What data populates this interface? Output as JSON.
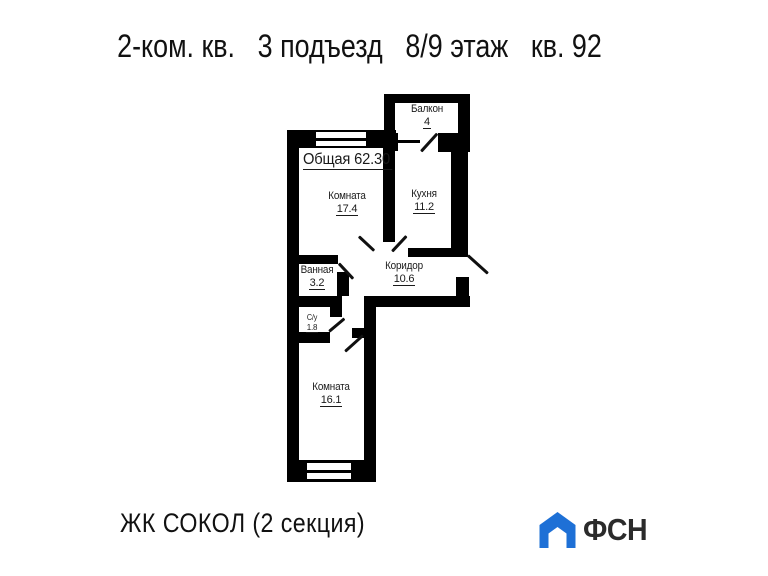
{
  "header": {
    "segments": [
      "2-ком. кв.",
      "3 подъезд",
      "8/9 этаж",
      "кв. 92"
    ]
  },
  "plan": {
    "total_label": "Общая 62.30",
    "rooms": [
      {
        "id": "balcony",
        "name": "Балкон",
        "area": "4"
      },
      {
        "id": "room-1",
        "name": "Комната",
        "area": "17.4"
      },
      {
        "id": "kitchen",
        "name": "Кухня",
        "area": "11.2"
      },
      {
        "id": "bathroom",
        "name": "Ванная",
        "area": "3.2"
      },
      {
        "id": "corridor",
        "name": "Коридор",
        "area": "10.6"
      },
      {
        "id": "wc",
        "name": "С/у",
        "area": "1.8"
      },
      {
        "id": "room-2",
        "name": "Комната",
        "area": "16.1"
      }
    ]
  },
  "footer": {
    "project_title": "ЖК СОКОЛ (2 секция)",
    "logo": {
      "text": "ФСН",
      "icon": "house-icon",
      "icon_color": "#1e70d6",
      "text_color": "#2b2b2b"
    }
  },
  "colors": {
    "walls": "#000000",
    "text": "#1a1a1a",
    "background": "#ffffff"
  }
}
